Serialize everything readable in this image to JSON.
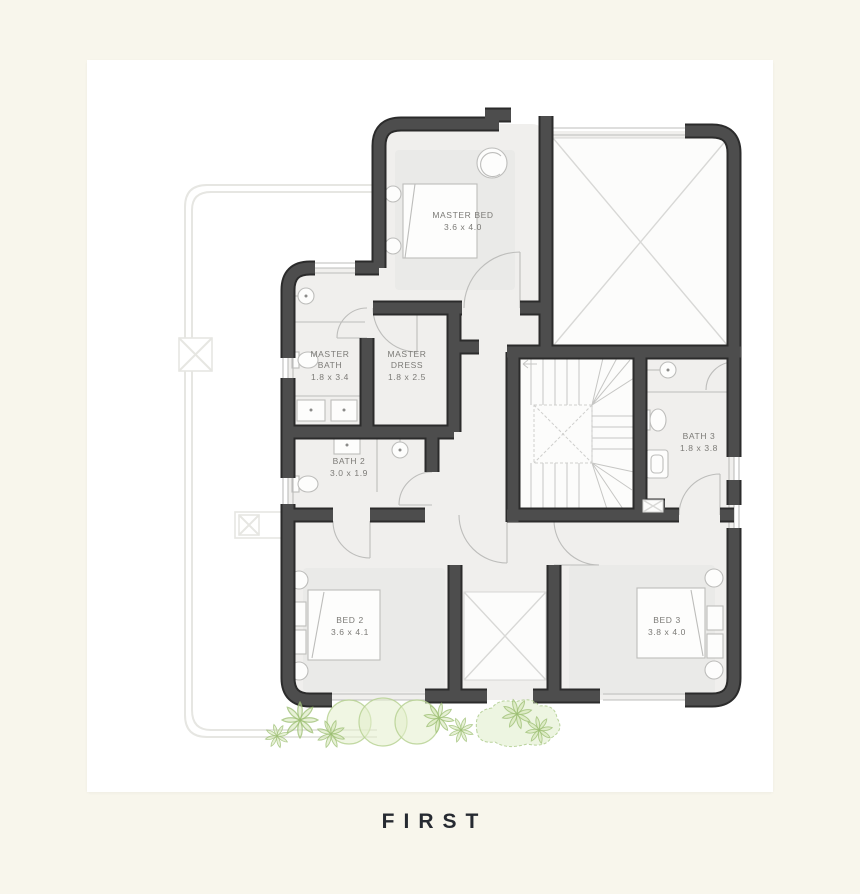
{
  "page": {
    "background": "#f8f6ec",
    "card_background": "#ffffff"
  },
  "caption": {
    "text": "FIRST"
  },
  "plan": {
    "colors": {
      "wall": "#4d4d4d",
      "wall_outline": "#2b2b2b",
      "room_fill": "#f0efed",
      "thin_line": "#bdbdbb",
      "label": "#7b7a76",
      "ghost_outline": "#e6e6e2",
      "plant_green": "#cfe3ae"
    },
    "rooms": [
      {
        "id": "master-bed",
        "name": "MASTER BED",
        "dims": "3.6 x 4.0"
      },
      {
        "id": "master-bath",
        "name1": "MASTER",
        "name2": "BATH",
        "dims": "1.8 x 3.4"
      },
      {
        "id": "master-dress",
        "name1": "MASTER",
        "name2": "DRESS",
        "dims": "1.8 x 2.5"
      },
      {
        "id": "bath-2",
        "name": "BATH 2",
        "dims": "3.0 x 1.9"
      },
      {
        "id": "bath-3",
        "name": "BATH 3",
        "dims": "1.8 x 3.8"
      },
      {
        "id": "bed-2",
        "name": "BED 2",
        "dims": "3.6 x 4.1"
      },
      {
        "id": "bed-3",
        "name": "BED 3",
        "dims": "3.8 x 4.0"
      }
    ]
  }
}
